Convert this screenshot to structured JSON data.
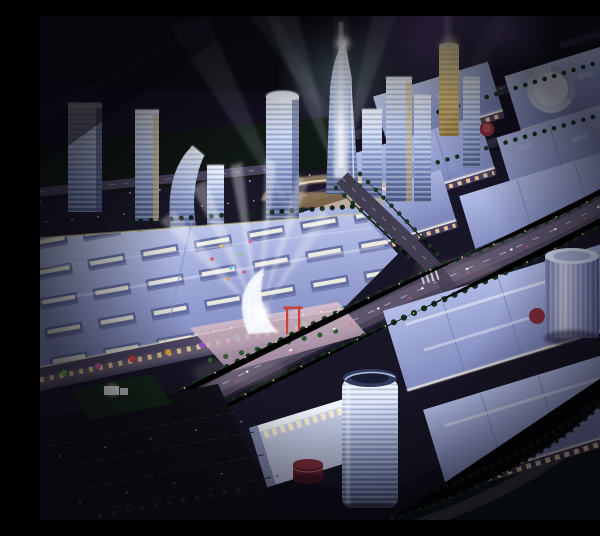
{
  "image": {
    "type": "architectural night rendering",
    "view": "aerial perspective",
    "description": "Night aerial rendering of a large mixed-use development: a cluster of glowing glass office towers with crisscrossing searchlight beams, rows of illuminated lavender-roofed shopping mall blocks, tree-lined boulevards with street lamps, a white gateway arch radiating spotlights over a plaza, cylindrical towers, a rooftop drum, red pavilions and dark parkland at the edges",
    "palette": {
      "sky_dark": "#110d1a",
      "sky_glow_purple": "#7b5ea8",
      "beam_white": "#e6f2ff",
      "roof_lavender": "#b7c1ea",
      "roof_shadow": "#7e88ba",
      "facade_warm": "#f3cf9e",
      "tower_glass": "#cfe0f8",
      "tower_gold": "#e6c873",
      "tree_green": "#1d3823",
      "road_asphalt": "#4a4458",
      "lamp_amber": "#ffdf9e",
      "ground_dark": "#0d1411",
      "plaza_pink": "#e3c3cb",
      "accent_red": "#c9403a",
      "accent_magenta": "#d05a9e",
      "accent_green": "#76c14e",
      "accent_orange": "#e8a23c"
    },
    "features": {
      "districts": [
        "office tower cluster",
        "north mall rows",
        "west mall complex",
        "south-east mall rows",
        "gateway plaza",
        "parkland and parking edge"
      ],
      "tower_count": 12,
      "mall_block_count": 9,
      "cylindrical_tower_count": 2,
      "searchlight_beam_count": 7,
      "landmarks": [
        "tapered spire tower with vertical light beam",
        "gold cylindrical tower",
        "white rooftop drum",
        "gateway arch with radiating spotlights",
        "red gate poles",
        "round red pavilions"
      ]
    },
    "lighting": {
      "time_of_day": "night",
      "sources": [
        "searchlight beams",
        "facade billboard strips",
        "street lamps",
        "rooftop skylight monitors"
      ]
    }
  }
}
